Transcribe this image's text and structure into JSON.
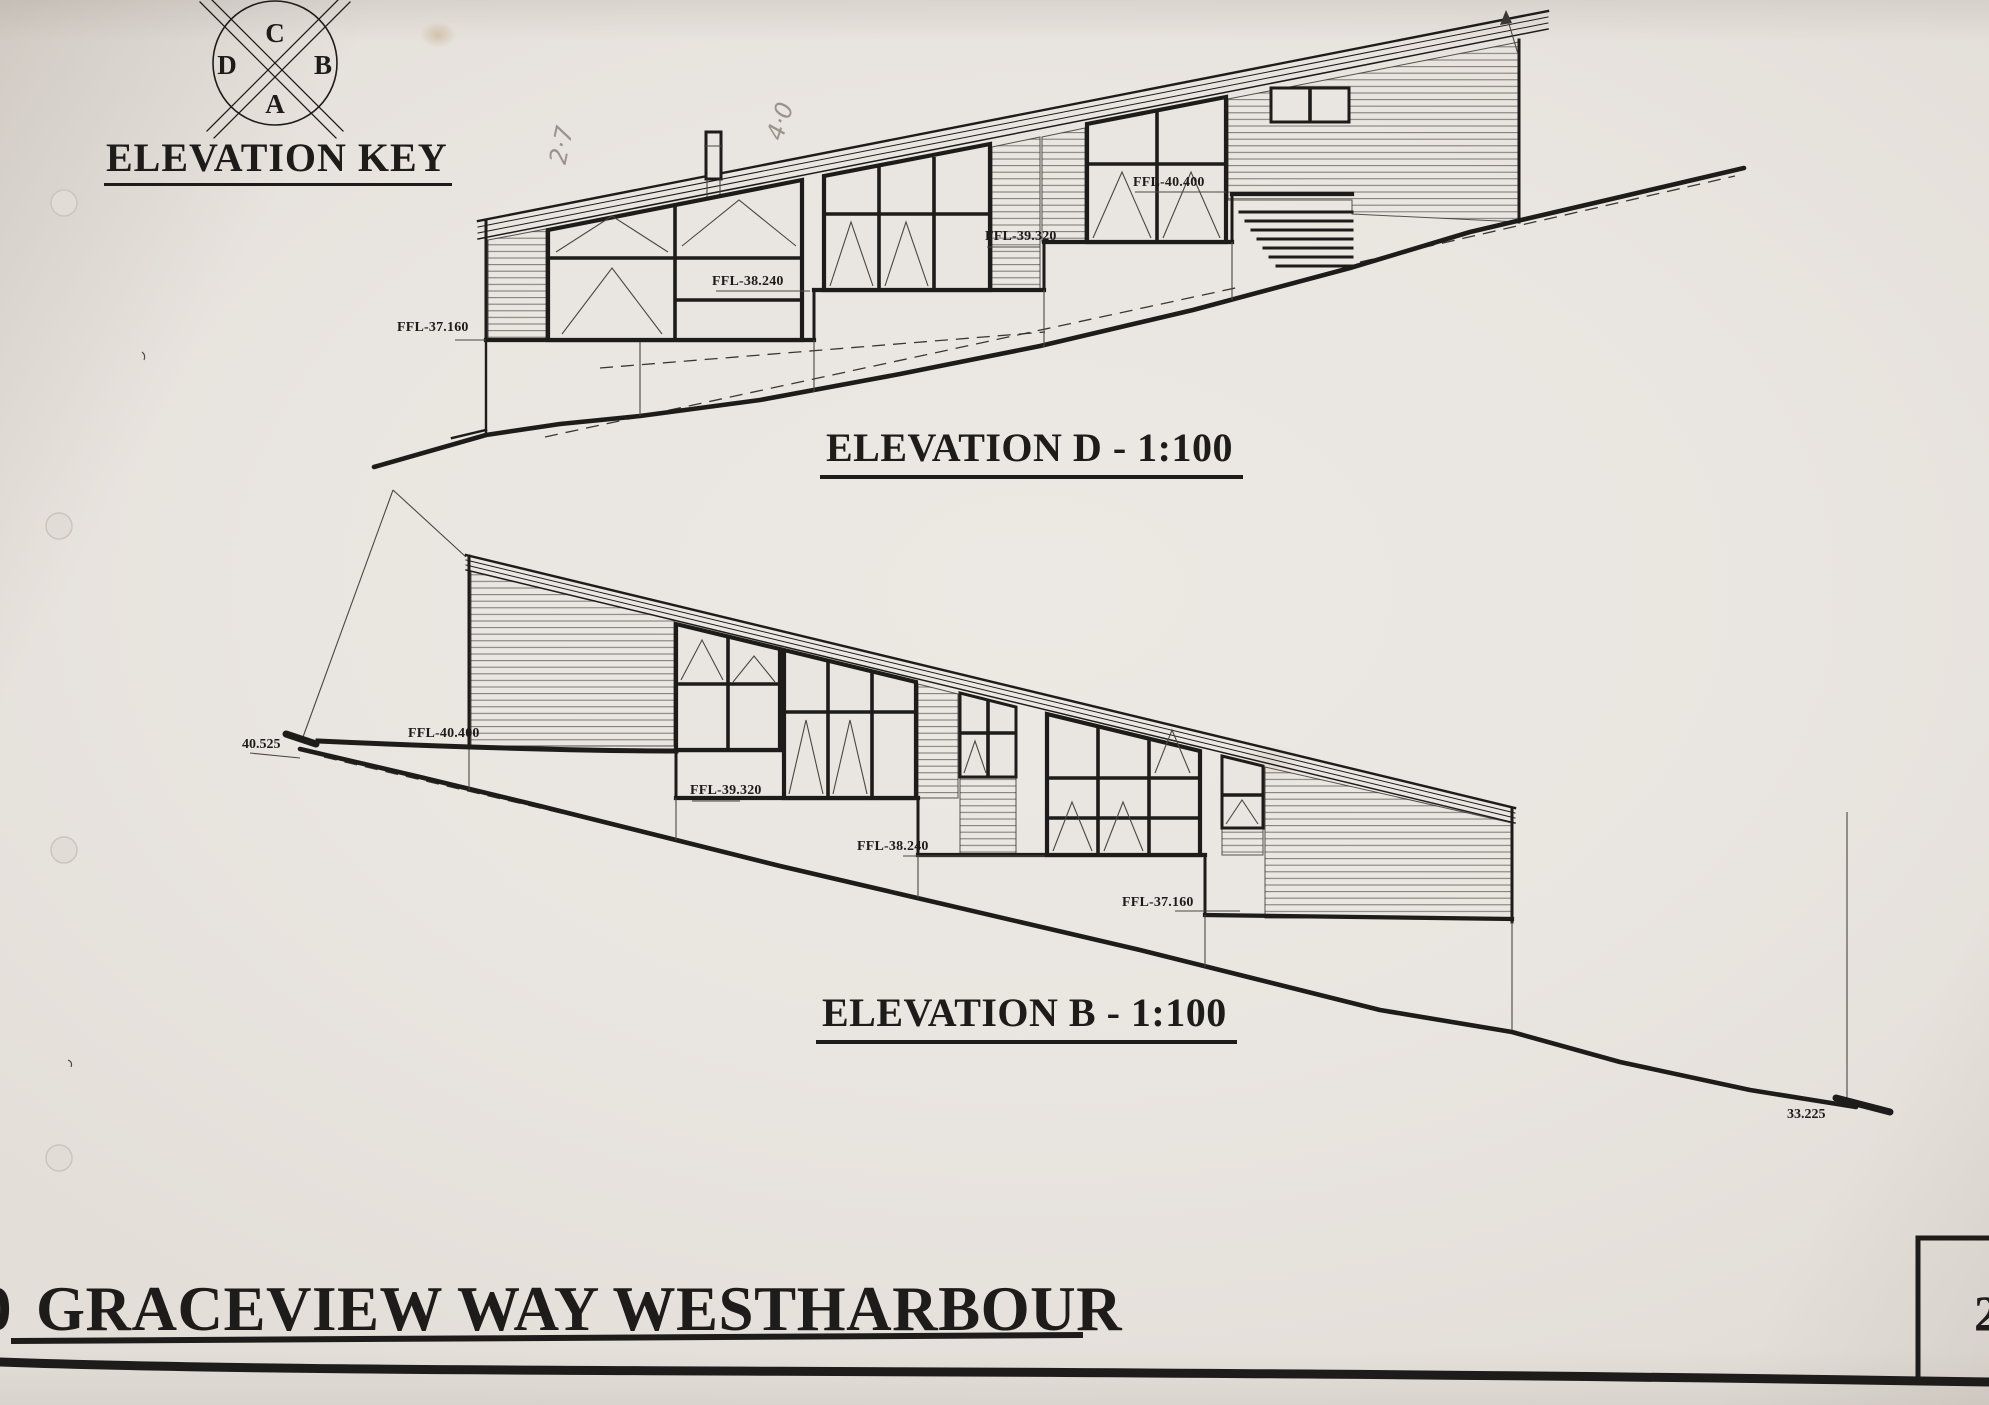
{
  "colors": {
    "paper": "#e9e5e0",
    "ink": "#1e1c1a",
    "pencil": "#9a938c"
  },
  "elevation_key": {
    "title": "ELEVATION KEY",
    "letter_top": "C",
    "letter_left": "D",
    "letter_right": "B",
    "letter_bottom": "A"
  },
  "elevation_d": {
    "title": "ELEVATION D - 1:100",
    "ffl_40_400": "FFL-40.400",
    "ffl_39_320": "FFL-39.320",
    "ffl_38_240": "FFL-38.240",
    "ffl_37_160": "FFL-37.160",
    "pencil_note_1": "2·7",
    "pencil_note_2": "4·0"
  },
  "elevation_b": {
    "title": "ELEVATION B - 1:100",
    "datum_left": "40.525",
    "ffl_40_400": "FFL-40.400",
    "ffl_39_320": "FFL-39.320",
    "ffl_38_240": "FFL-38.240",
    "ffl_37_160": "FFL-37.160",
    "datum_right": "33.225"
  },
  "footer": {
    "project_title": "GRACEVIEW WAY WESTHARBOUR",
    "title_prefix_partial": "0",
    "sheet_number_partial": "2"
  }
}
